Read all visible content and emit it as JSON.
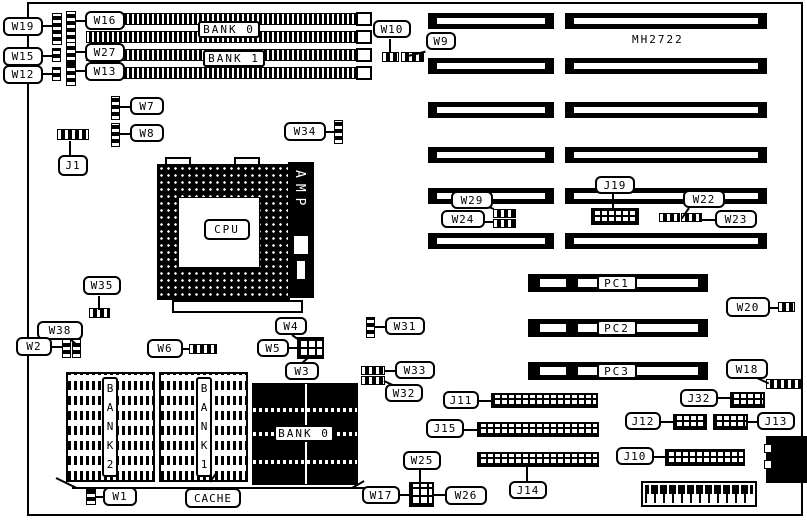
{
  "model": "MH2722",
  "callouts": {
    "w19": "W19",
    "w16": "W16",
    "w15": "W15",
    "w27": "W27",
    "w12": "W12",
    "w13": "W13",
    "w10": "W10",
    "w9": "W9",
    "w7": "W7",
    "w8": "W8",
    "j1": "J1",
    "w34": "W34",
    "w35": "W35",
    "w38": "W38",
    "w2": "W2",
    "w6": "W6",
    "w4": "W4",
    "w5": "W5",
    "w3": "W3",
    "w31": "W31",
    "w33": "W33",
    "w32": "W32",
    "w29": "W29",
    "w24": "W24",
    "j19": "J19",
    "w22": "W22",
    "w23": "W23",
    "w20": "W20",
    "w18": "W18",
    "j11": "J11",
    "j15": "J15",
    "j14": "J14",
    "w25": "W25",
    "w17": "W17",
    "w26": "W26",
    "j32": "J32",
    "j12": "J12",
    "j13": "J13",
    "j10": "J10",
    "w1": "W1",
    "cache": "CACHE"
  },
  "components": {
    "bank0_top": "BANK 0",
    "bank1_top": "BANK 1",
    "cpu": "CPU",
    "amp": "AMP",
    "bank2_dip": "BANK2",
    "bank1_dip": "BANK1",
    "bank0_simm": "BANK 0",
    "pci_slots": [
      "PC1",
      "PC2",
      "PC3"
    ]
  }
}
